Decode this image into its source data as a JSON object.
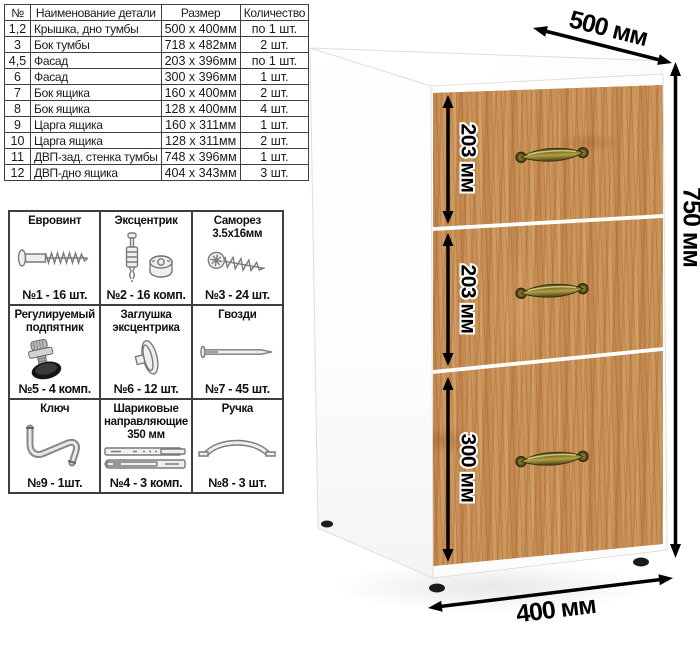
{
  "parts_table": {
    "headers": [
      "№",
      "Наименование детали",
      "Размер",
      "Количество"
    ],
    "rows": [
      [
        "1,2",
        "Крышка, дно тумбы",
        "500 х 400мм",
        "по 1 шт."
      ],
      [
        "3",
        "Бок тумбы",
        "718 х 482мм",
        "2 шт."
      ],
      [
        "4,5",
        "Фасад",
        "203 х 396мм",
        "по 1 шт."
      ],
      [
        "6",
        "Фасад",
        "300 х 396мм",
        "1 шт."
      ],
      [
        "7",
        "Бок ящика",
        "160 х 400мм",
        "2 шт."
      ],
      [
        "8",
        "Бок ящика",
        "128 х 400мм",
        "4 шт."
      ],
      [
        "9",
        "Царга ящика",
        "160 х 311мм",
        "1 шт."
      ],
      [
        "10",
        "Царга ящика",
        "128 х 311мм",
        "2 шт."
      ],
      [
        "11",
        "ДВП-зад. стенка тумбы",
        "748 х 396мм",
        "1 шт."
      ],
      [
        "12",
        "ДВП-дно ящика",
        "404 х 343мм",
        "3 шт."
      ]
    ]
  },
  "hardware": {
    "items": [
      {
        "title": "Евровинт",
        "count": "№1 - 16 шт.",
        "icon": "euro-screw-icon"
      },
      {
        "title": "Эксцентрик",
        "count": "№2 - 16 комп.",
        "icon": "eccentric-cam-icon"
      },
      {
        "title": "Саморез 3.5х16мм",
        "count": "№3 - 24 шт.",
        "icon": "self-tapping-screw-icon"
      },
      {
        "title": "Регулируемый подпятник",
        "count": "№5 - 4 комп.",
        "icon": "adjustable-foot-icon"
      },
      {
        "title": "Заглушка эксцентрика",
        "count": "№6 - 12 шт.",
        "icon": "cam-cap-icon"
      },
      {
        "title": "Гвозди",
        "count": "№7 - 45 шт.",
        "icon": "nail-icon"
      },
      {
        "title": "Ключ",
        "count": "№9 - 1шт.",
        "icon": "hex-key-icon"
      },
      {
        "title": "Шариковые направляющие 350 мм",
        "count": "№4 - 3 комп.",
        "icon": "ball-slides-icon"
      },
      {
        "title": "Ручка",
        "count": "№8 - 3 шт.",
        "icon": "drawer-handle-icon"
      }
    ]
  },
  "cabinet": {
    "dimensions": {
      "depth": "500 мм",
      "height": "750 мм",
      "width": "400 мм",
      "drawer1": "203 мм",
      "drawer2": "203 мм",
      "drawer3": "300 мм"
    },
    "colors": {
      "wood": "#c78e55",
      "handle_brass": "#8a7d33",
      "body": "#ffffff",
      "dimension": "#000000"
    }
  }
}
